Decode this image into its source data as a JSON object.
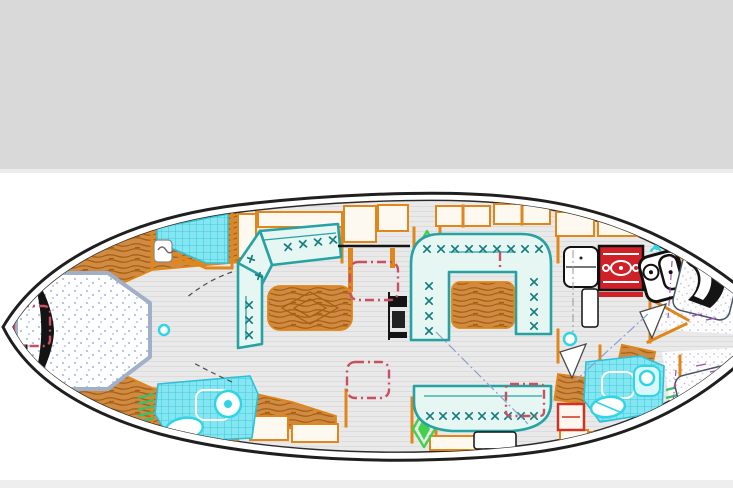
{
  "meta": {
    "type": "yacht-interior-floor-plan",
    "view": "top-down-deck-plan",
    "orientation": "bow-left-stern-right"
  },
  "header": {
    "panel": "empty-gray-panel"
  },
  "colors": {
    "page_bg": "#ffffff",
    "bg_gray": "#d9d9d9",
    "divider": "#eeeceb",
    "footer_strip": "#efeeee",
    "hull": "#1f1f1f",
    "joinery": "#e0861a",
    "wood_fill": "#d18a41",
    "wood_grain": "#a35f14",
    "sole": "#e9e9e9",
    "sole_line": "#dcdcdc",
    "settee_fill": "#e6f6f3",
    "settee_stroke": "#27a2a2",
    "settee_mark": "#157d7d",
    "tile_fill": "#83e6f0",
    "tile_line": "#2fc0d8",
    "fixture": "#2fd5e6",
    "bed_stroke": "#9fb0c8",
    "bed_dot": "#9db4d8",
    "stove_red": "#cf2127",
    "hatch_red": "#c94f62",
    "vent_green": "#3ed24d",
    "anno_purple": "#a050b0",
    "door_gray": "#4a4a4a",
    "center_dash": "#8fa0d0",
    "black": "#141414"
  },
  "regions": [
    {
      "id": "owner-cabin",
      "role": "v-berth-double-bed"
    },
    {
      "id": "forward-head",
      "role": "shower-and-sink"
    },
    {
      "id": "forward-bathroom",
      "role": "toilet-and-sink"
    },
    {
      "id": "salon",
      "role": "corner-settee-with-table"
    },
    {
      "id": "mast-area",
      "role": "mast-post-hatches-vents"
    },
    {
      "id": "dinette",
      "role": "u-shaped-settee-with-table"
    },
    {
      "id": "aft-bench",
      "role": "curved-settee"
    },
    {
      "id": "galley",
      "role": "fridge-stove-double-sink"
    },
    {
      "id": "aft-head",
      "role": "shower-toilet-sink"
    },
    {
      "id": "aft-cabin-port",
      "role": "double-berth"
    },
    {
      "id": "aft-cabin-starboard",
      "role": "double-berth"
    }
  ]
}
